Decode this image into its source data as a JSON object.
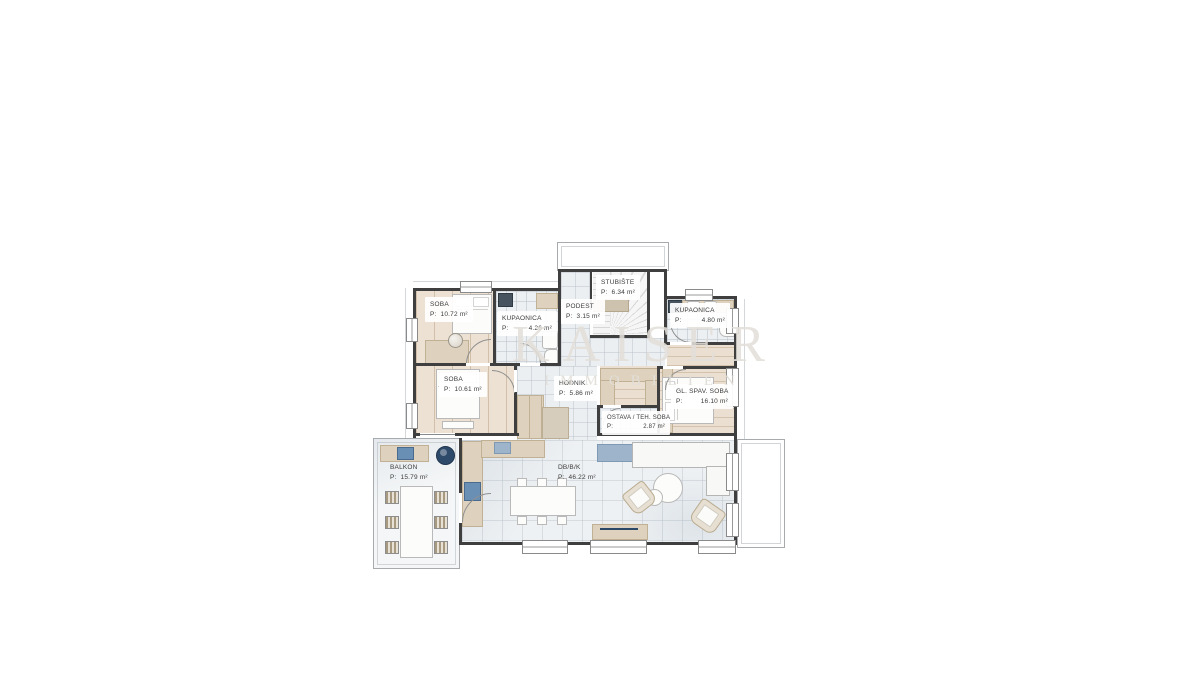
{
  "watermark": {
    "brand": "KAISER",
    "sub": "IMMOBILIEN"
  },
  "rooms": {
    "soba1": {
      "name": "SOBA",
      "p": "P:",
      "area": "10.72 m²"
    },
    "kupaonica1": {
      "name": "KUPAONICA",
      "p": "P:",
      "area": "4.26 m²"
    },
    "podest": {
      "name": "PODEST",
      "p": "P:",
      "area": "3.15 m²"
    },
    "stubiste": {
      "name": "STUBIŠTE",
      "p": "P:",
      "area": "6.34 m²"
    },
    "kupaonica2": {
      "name": "KUPAONICA",
      "p": "P:",
      "area": "4.80 m²"
    },
    "soba2": {
      "name": "SOBA",
      "p": "P:",
      "area": "10.61 m²"
    },
    "hodnik": {
      "name": "HODNIK",
      "p": "P:",
      "area": "5.86 m²"
    },
    "glspav": {
      "name": "GL. SPAV. SOBA",
      "p": "P:",
      "area": "16.10 m²"
    },
    "ostava": {
      "name": "OSTAVA / TEH. SOBA",
      "p": "P:",
      "area": "2.87 m²"
    },
    "balkon": {
      "name": "BALKON",
      "p": "P:",
      "area": "15.79 m²"
    },
    "dbbk": {
      "name": "DB/B/K",
      "p": "P:",
      "area": "46.22 m²"
    }
  },
  "colors": {
    "wall": "#3f3f3f",
    "tile_floor": "#edf0f2",
    "wood_floor": "#ece1d3",
    "furniture_beige": "#ded2be",
    "accent_blue": "#6a8fb4",
    "dark_blue": "#2e4a6b",
    "watermark_gray": "#e2ded8"
  }
}
